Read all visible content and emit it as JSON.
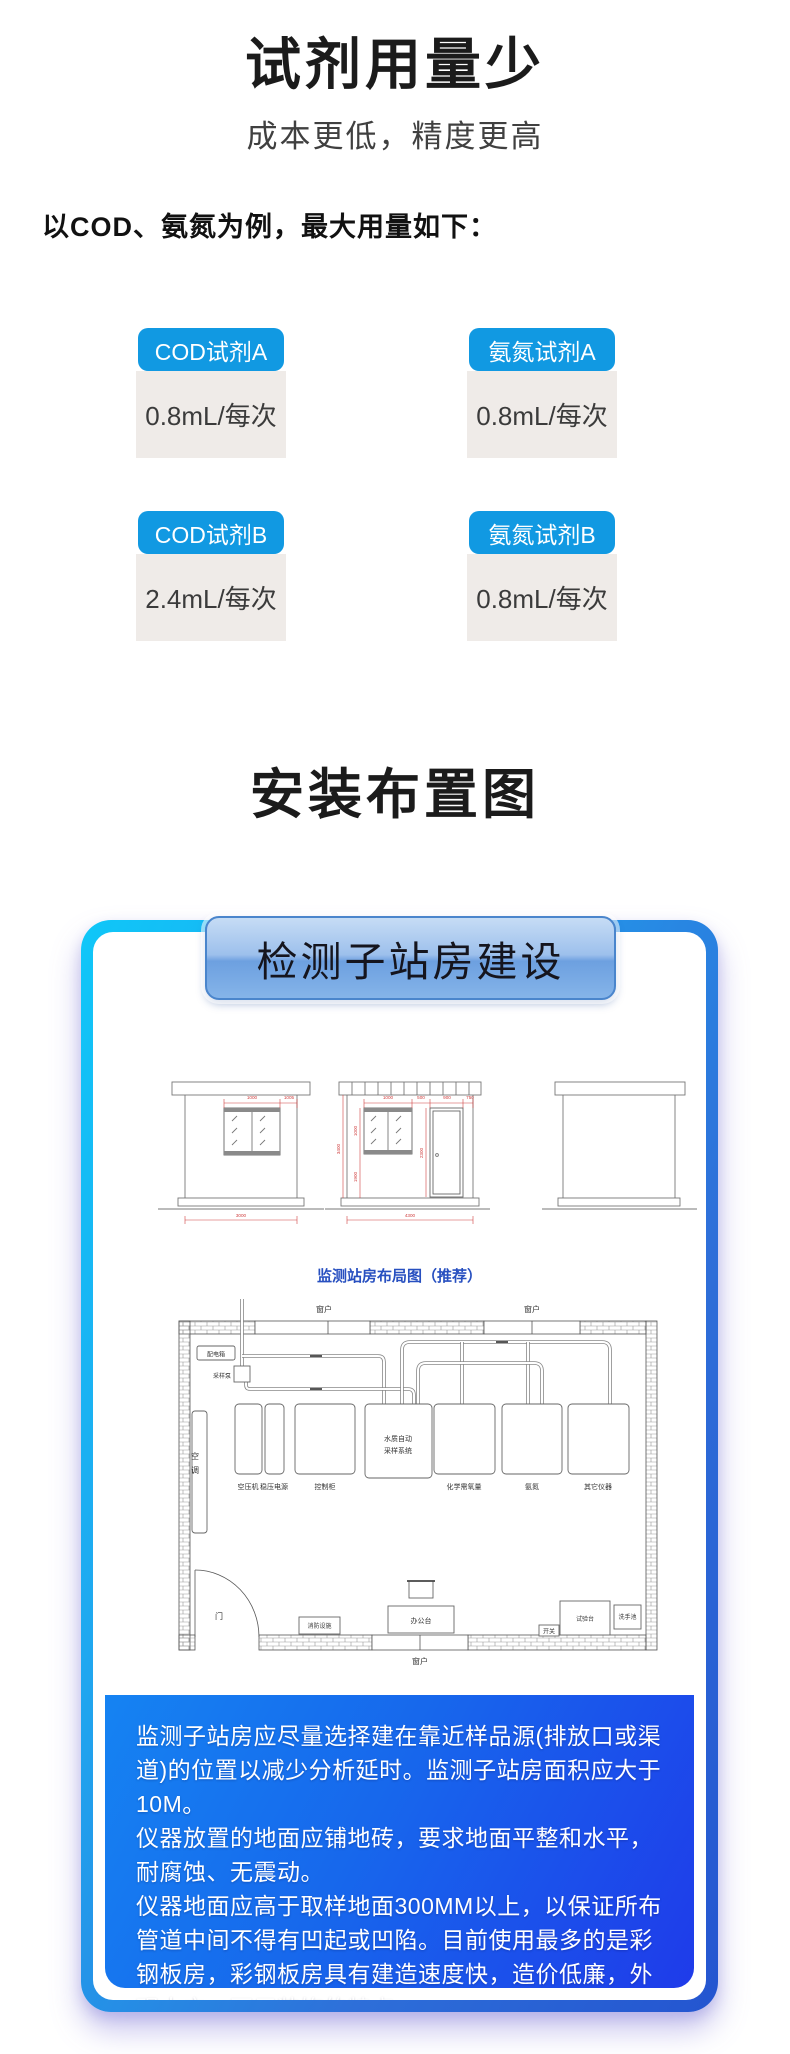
{
  "css_vars": {
    "--accent": "#1199E2",
    "--value-box": "#EFEBE8",
    "--frame-cyan": "#0FC7F8",
    "--frame-mid": "#1FA8F0",
    "--frame-blue": "#2E6FD9",
    "--frame-deep": "#2455D0",
    "--panel-top": "#1583F2",
    "--panel-mid": "#1767EC",
    "--panel-deep": "#1F3BEA",
    "--plan-blue": "#2850C0",
    "--dim-red": "#D04040"
  },
  "hero": {
    "title": "试剂用量少",
    "subtitle": "成本更低，精度更高",
    "intro": "以COD、氨氮为例，最大用量如下："
  },
  "reagents": {
    "cards": [
      {
        "label": "COD试剂A",
        "value": "0.8mL/每次"
      },
      {
        "label": "氨氮试剂A",
        "value": "0.8mL/每次"
      },
      {
        "label": "COD试剂B",
        "value": "2.4mL/每次"
      },
      {
        "label": "氨氮试剂B",
        "value": "0.8mL/每次"
      }
    ]
  },
  "install": {
    "title": "安装布置图"
  },
  "station": {
    "header": "检测子站房建设",
    "plan_title": "监测站房布局图（推荐）",
    "elevations": {
      "b1": {
        "dim_top_1": "1000",
        "dim_top_2": "1005",
        "dim_bottom": "3000"
      },
      "b2": {
        "dim_height": "3400",
        "dim_top_1": "1000",
        "dim_top_2": "500",
        "dim_top_3": "900",
        "dim_top_4": "750",
        "dim_window": "1000",
        "dim_under_window": "1900",
        "dim_door": "2300",
        "dim_bottom": "4300"
      }
    },
    "plan": {
      "window": "窗户",
      "door": "门",
      "power_box": "配电箱",
      "pump": "采样泵",
      "ac": "空调",
      "sampler_1": "水质自动",
      "sampler_2": "采样系统",
      "eq_1": "空压机",
      "eq_2": "稳压电源",
      "eq_3": "控制柜",
      "eq_4": "化学需氧量",
      "eq_5": "氨氮",
      "eq_6": "其它仪器",
      "fire": "消防设施",
      "desk": "办公台",
      "switch": "开关",
      "bench": "试验台",
      "sink": "洗手池"
    },
    "paragraphs": [
      "监测子站房应尽量选择建在靠近样品源(排放口或渠道)的位置以减少分析延时。监测子站房面积应大于10M。",
      "仪器放置的地面应铺地砖，要求地面平整和水平，耐腐蚀、无震动。",
      "仪器地面应高于取样地面300MM以上，以保证所布管道中间不得有凹起或凹陷。目前使用最多的是彩钢板房，彩钢板房具有建造速度快，造价低廉，外观大方，不用装饰的特点。"
    ]
  }
}
